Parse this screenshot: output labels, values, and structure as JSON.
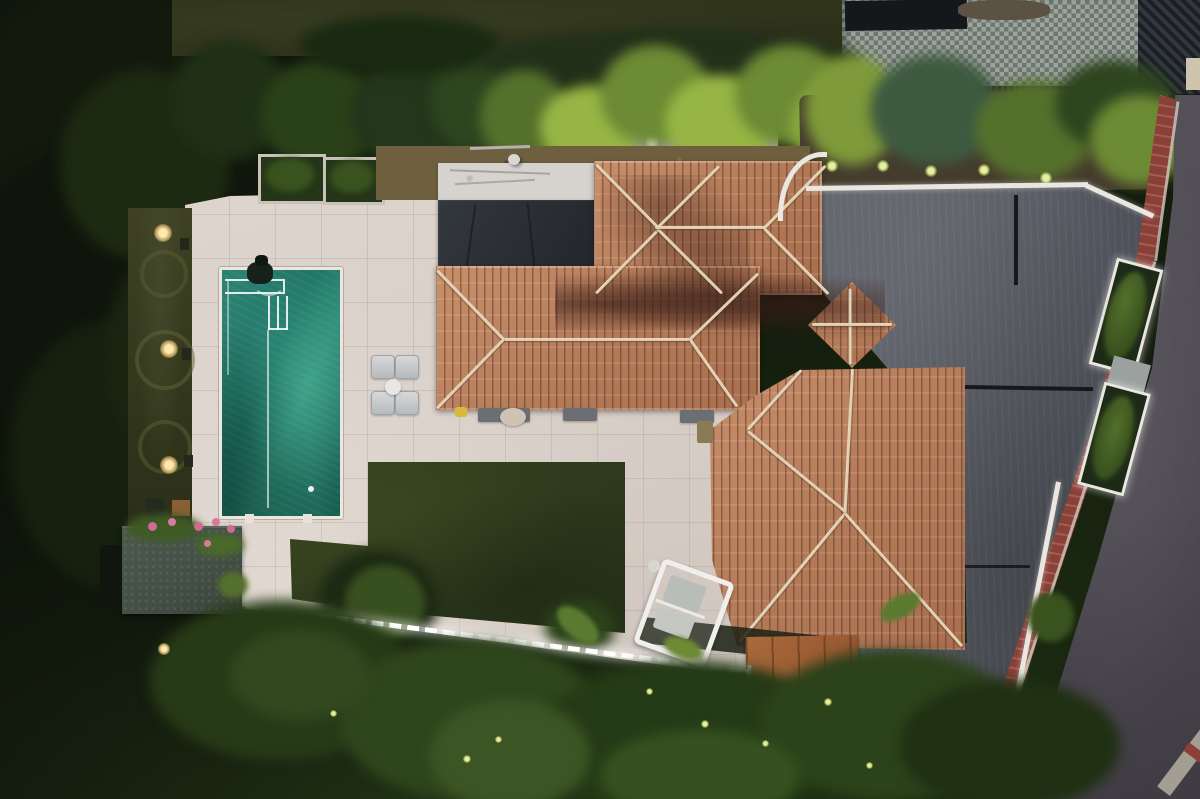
{
  "scene": {
    "meta": {
      "type": "aerial-drone-photo",
      "time_of_day": "dusk",
      "subject": "Aerial top-down view of a Mediterranean villa with terracotta hip roofs, rectangular pool, travertine patio, lawn, gray driveway and curved street at dusk with landscape lighting"
    },
    "elements": {
      "photo": {
        "label": "aerial photo of villa at dusk"
      },
      "pool": {
        "label": "rectangular swimming pool with teal water"
      },
      "pool_steps": {
        "label": "pool corner steps and ladder lines"
      },
      "pool_cleaner": {
        "label": "pool cleaning robot near steps"
      },
      "patio": {
        "label": "light travertine patio terrace"
      },
      "loungers": {
        "label": "four white sun loungers"
      },
      "lounge_table": {
        "label": "round white side table"
      },
      "lawn": {
        "label": "dark green lawn rectangle"
      },
      "roof": {
        "label": "terracotta tiled hip roof of villa"
      },
      "white_roof": {
        "label": "white flat roof section"
      },
      "solar_canopy": {
        "label": "dark charcoal roof panel"
      },
      "pavilion_roof": {
        "label": "small square pavilion roof"
      },
      "burnt_tiles": {
        "label": "darker weathered tile band"
      },
      "driveway": {
        "label": "gray concrete driveway"
      },
      "road": {
        "label": "asphalt street curving along property"
      },
      "sidewalk": {
        "label": "red brick sidewalk strip"
      },
      "curb": {
        "label": "light curb at street corner"
      },
      "boundary_wall": {
        "label": "white boundary wall with LED lighting"
      },
      "planters": {
        "label": "white planter boxes with green shrubs"
      },
      "gate": {
        "label": "gray pedestrian gate"
      },
      "swing_chair": {
        "label": "white frame garden swing chair"
      },
      "shed": {
        "label": "garden shed with dark textured roof"
      },
      "flower_bed": {
        "label": "pink flower planters on shed"
      },
      "deck": {
        "label": "wooden deck platform"
      },
      "led_path": {
        "label": "LED strip along garden edge"
      },
      "gravel_bed": {
        "label": "gravel planting strip with uplights"
      },
      "palm_row": {
        "label": "row of palm trees with uplighting"
      },
      "hedge": {
        "label": "dark conifer hedge"
      },
      "garden": {
        "label": "wild dark garden vegetation"
      },
      "grass_strip": {
        "label": "side grass strip with warm garden lights"
      },
      "neighbor_patio": {
        "label": "neighbor mosaic tiled patio"
      },
      "pergola": {
        "label": "black slatted pergola roof"
      },
      "doormats": {
        "label": "dark doormats along facade"
      },
      "planter_squares": {
        "label": "two square stone planters with shrubs"
      },
      "roof_vent": {
        "label": "white roof vent"
      }
    }
  },
  "palette": {
    "vegetation_dark": "#141c0e",
    "vegetation_mid": "#243a17",
    "vegetation_light": "#3c5522",
    "lawn_neighbor": "#31351c",
    "lawn_main": "#36431f",
    "lawn_dark": "#27331a",
    "patio": "#d8cfc8",
    "pool_light": "#39957f",
    "pool_mid": "#1f7466",
    "pool_dark": "#145247",
    "pool_edge": "#ece6de",
    "roof_tile": "#b27a57",
    "roof_tile_light": "#c98f6b",
    "roof_ridge": "#e9dcc2",
    "roof_white": "#d6d3ce",
    "roof_charcoal": "#2b2f34",
    "driveway": "#585b63",
    "driveway_dark": "#44474f",
    "joint_black": "#17181a",
    "road": "#4e4a52",
    "sidewalk_red": "#8a4037",
    "curb": "#a39d94",
    "wall_white": "#eae7e1",
    "gravel": "#a29f99",
    "dirt": "#6e5f3e",
    "palm_bright": "#96b544",
    "palm_mid": "#6d8a34",
    "conifer": "#2e451f",
    "conifer_teal": "#3d5a40",
    "shed": "#434e44",
    "flower_pink": "#cf6a92",
    "deck_wood": "#9a5a33",
    "warm_light": "#ffd98a",
    "mosaic_light": "#9ba49d",
    "mosaic_dark": "#6e776f",
    "slat_black": "#202428",
    "furniture_white": "#eceae6"
  }
}
